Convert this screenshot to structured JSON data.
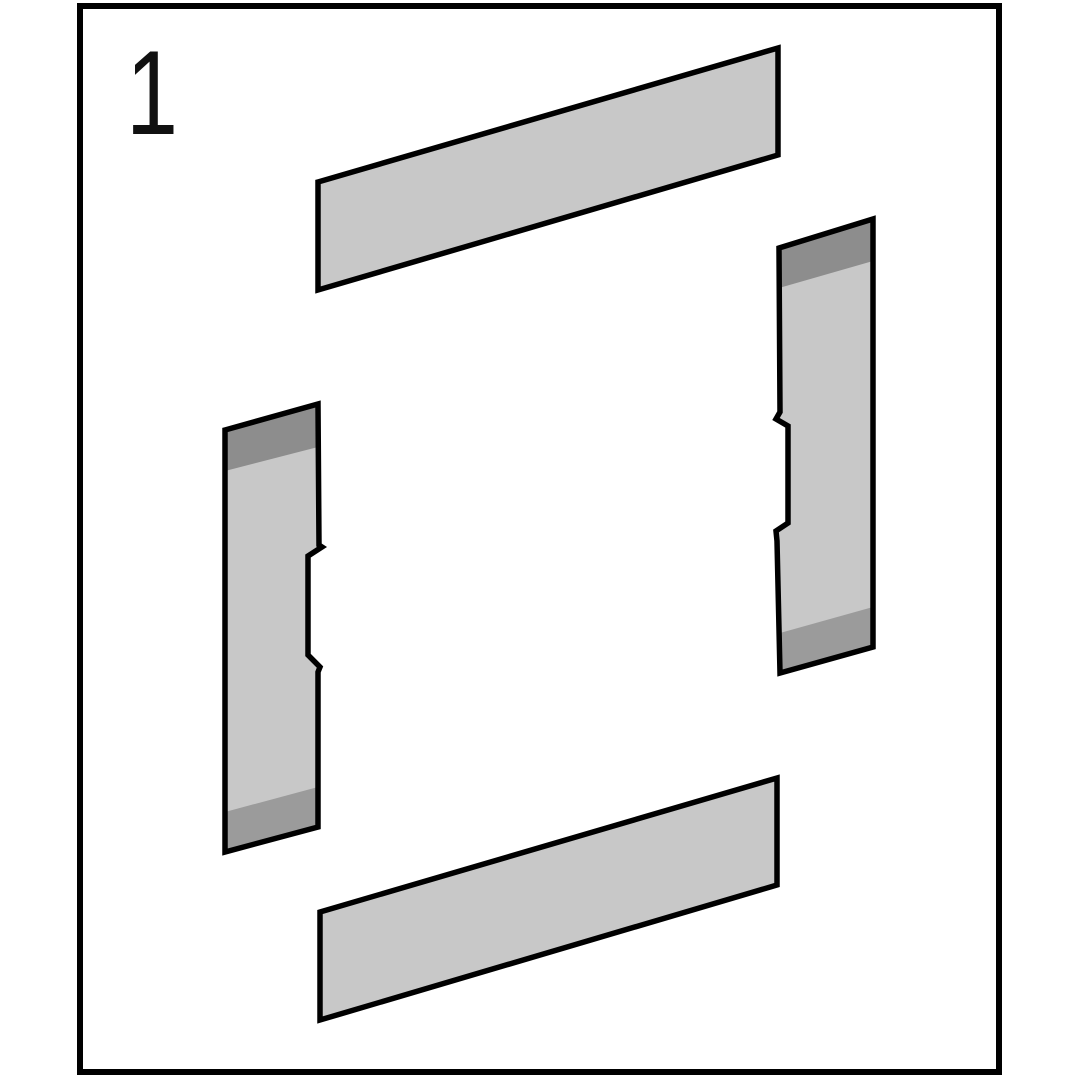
{
  "page": {
    "background": "#ffffff",
    "border_color": "#000000"
  },
  "step": {
    "number": "1"
  },
  "diagram": {
    "outline_color": "#000000",
    "outline_width": 5.5,
    "colors": {
      "face": "#c8c8c8",
      "edge_top": "#8d8d8d",
      "edge_bottom": "#9b9b9b"
    },
    "panels": [
      {
        "name": "top-rail",
        "outline": "318,182 778,48 778,155 318,290",
        "bands": []
      },
      {
        "name": "right-stile",
        "outline": "779,248 873,219 873,647 780,673 777,541 776,531 788,523 788,426 776,419 780,412",
        "bands": [
          {
            "tone": "edge_top",
            "points": "779,248 873,219 873,261 779,288"
          },
          {
            "tone": "edge_bottom",
            "points": "780,633 873,607 873,647 780,673"
          }
        ]
      },
      {
        "name": "left-stile",
        "outline": "225,430 318,404 319,545 322,547 308,556 308,655 320,667 318,672 318,827 225,852",
        "bands": [
          {
            "tone": "edge_top",
            "points": "225,430 318,404 318,447 225,471"
          },
          {
            "tone": "edge_bottom",
            "points": "225,812 318,787 318,827 225,852"
          }
        ]
      },
      {
        "name": "bottom-rail",
        "outline": "320,912 777,778 777,885 320,1020",
        "bands": []
      }
    ]
  }
}
